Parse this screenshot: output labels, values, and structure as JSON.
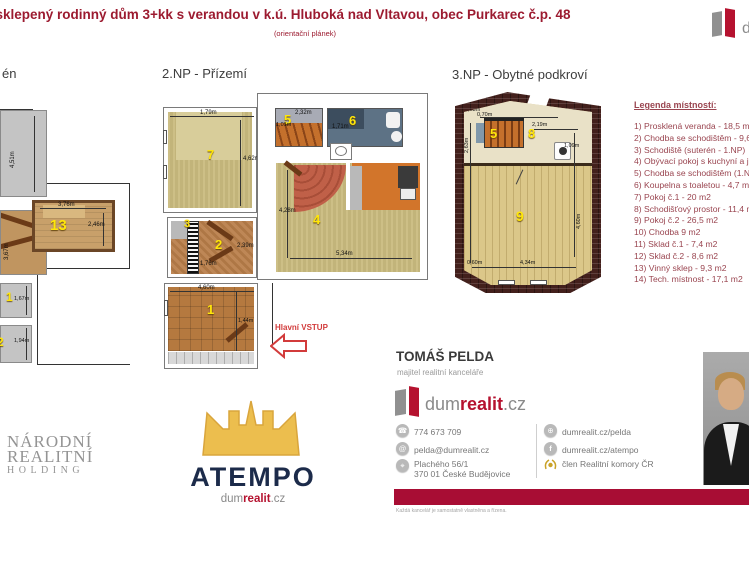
{
  "colors": {
    "accent_red": "#9c1b30",
    "legend_red": "#9a4550",
    "bar_red": "#a80d34",
    "brand_red": "#b5122f",
    "atempo_navy": "#1c2b4a",
    "crown_gold": "#ecbe4e"
  },
  "header": {
    "title": "Podsklepený rodinný dům 3+kk s verandou v k.ú. Hluboká nad Vltavou, obec Purkarec č.p. 48",
    "subtitle": "(orientační plánek)",
    "logo_letter": "d"
  },
  "legend": {
    "title": "Legenda místností:",
    "items": [
      "1) Prosklená veranda - 18,5 m2",
      "2) Chodba se schodištěm - 9,6 m2",
      "3) Schodiště (suterén - 1.NP)",
      "4) Obývací pokoj s kuchyní a jídelnou",
      "5) Chodba se schodištěm (1.NP - 2.NP)",
      "6) Koupelna s toaletou - 4,7 m2",
      "7) Pokoj č.1 - 20 m2",
      "8) Schodišťový prostor - 11,4 m2",
      "9) Pokoj č.2 - 26,5 m2",
      "10) Chodba 9 m2",
      "11) Sklad č.1 - 7,4 m2",
      "12) Sklad č.2 - 8,6 m2",
      "13) Vinný sklep - 9,3 m2",
      "14) Tech. místnost - 17,1 m2"
    ]
  },
  "plan1": {
    "label": "én",
    "dim_gray": "4,51m",
    "dim_stairs": "3,67m",
    "room13": {
      "number": "13",
      "dim_top": "3,76m",
      "dim_right": "2,46m"
    },
    "room11": {
      "number": "1",
      "dim": "1,67m"
    },
    "room12": {
      "number": "2",
      "dim": "1,94m"
    }
  },
  "plan2": {
    "label": "2.NP - Přízemí",
    "entrance": "Hlavní VSTUP",
    "room7": {
      "number": "7",
      "dim_top": "1,79m",
      "dim_right": "4,62m"
    },
    "room3": {
      "number": "3"
    },
    "room2": {
      "number": "2",
      "dim_right": "2,39m",
      "dim_bottom": "1,76m"
    },
    "room1": {
      "number": "1",
      "dim_top": "4,60m",
      "dim_inner": "1,44m"
    },
    "room5": {
      "number": "5",
      "dim_top": "2,32m",
      "dim_left": "1,01m"
    },
    "room6": {
      "number": "6",
      "dim_left": "1,71m"
    },
    "room4": {
      "number": "4",
      "dim_left": "4,28m",
      "dim_bottom": "5,34m"
    }
  },
  "plan3": {
    "label": "3.NP - Obytné podkroví",
    "room5": {
      "number": "5",
      "dim_a": "0,63m",
      "dim_b": "0,70m",
      "dim_left": "2,63m"
    },
    "room8": {
      "number": "8",
      "dim_top": "2,19m",
      "dim_right": "1,09m"
    },
    "room9": {
      "number": "9",
      "dim_right": "4,60m",
      "dim_bottom": "4,34m",
      "dim_left": "0,60m"
    }
  },
  "footer": {
    "narodni": {
      "line1": "NÁRODNÍ",
      "line2": "REALITNÍ",
      "line3": "HOLDING"
    },
    "atempo": {
      "name": "ATEMPO",
      "brand_dum": "dum",
      "brand_realit": "realit",
      "brand_cz": ".cz"
    },
    "agent": {
      "name": "TOMÁŠ PELDA",
      "role": "majitel realitní kanceláře",
      "brand_dum": "dum",
      "brand_realit": "realit",
      "brand_cz": ".cz",
      "phone": "774 673 709",
      "email": "pelda@dumrealit.cz",
      "address1": "Plachého 56/1",
      "address2": "370 01 České Budějovice",
      "web1": "dumrealit.cz/pelda",
      "web2": "dumrealit.cz/atempo",
      "member": "člen Realitní komory ČR",
      "disclaimer": "Každá kancelář je samostatně vlastněna a řízena."
    }
  }
}
